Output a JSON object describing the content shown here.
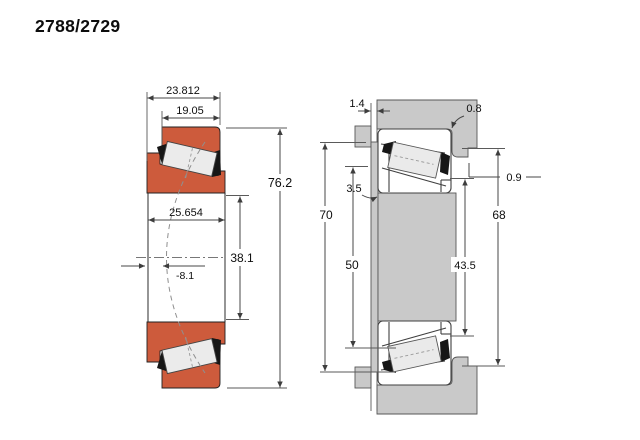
{
  "title": "2788/2729",
  "colors": {
    "bearing_orange": "#CD5B3C",
    "steel_gray": "#C9C9C9",
    "roller_gray": "#EBEBEB",
    "line": "#474747"
  },
  "section_view": {
    "overall_width": "23.812",
    "cup_width": "19.05",
    "cone_width": "25.654",
    "bore_diameter": "38.1",
    "outside_diameter": "76.2",
    "effective_center": "-8.1"
  },
  "mounting_view": {
    "clearance": "1.4",
    "housing_fillet": "0.8",
    "shaft_fillet": "3.5",
    "shaft_shoulder_diameter": "70",
    "shaft_backing_diameter": "50",
    "step_fillet": "0.9",
    "housing_shoulder_diameter": "68",
    "housing_backing_diameter": "43.5"
  }
}
